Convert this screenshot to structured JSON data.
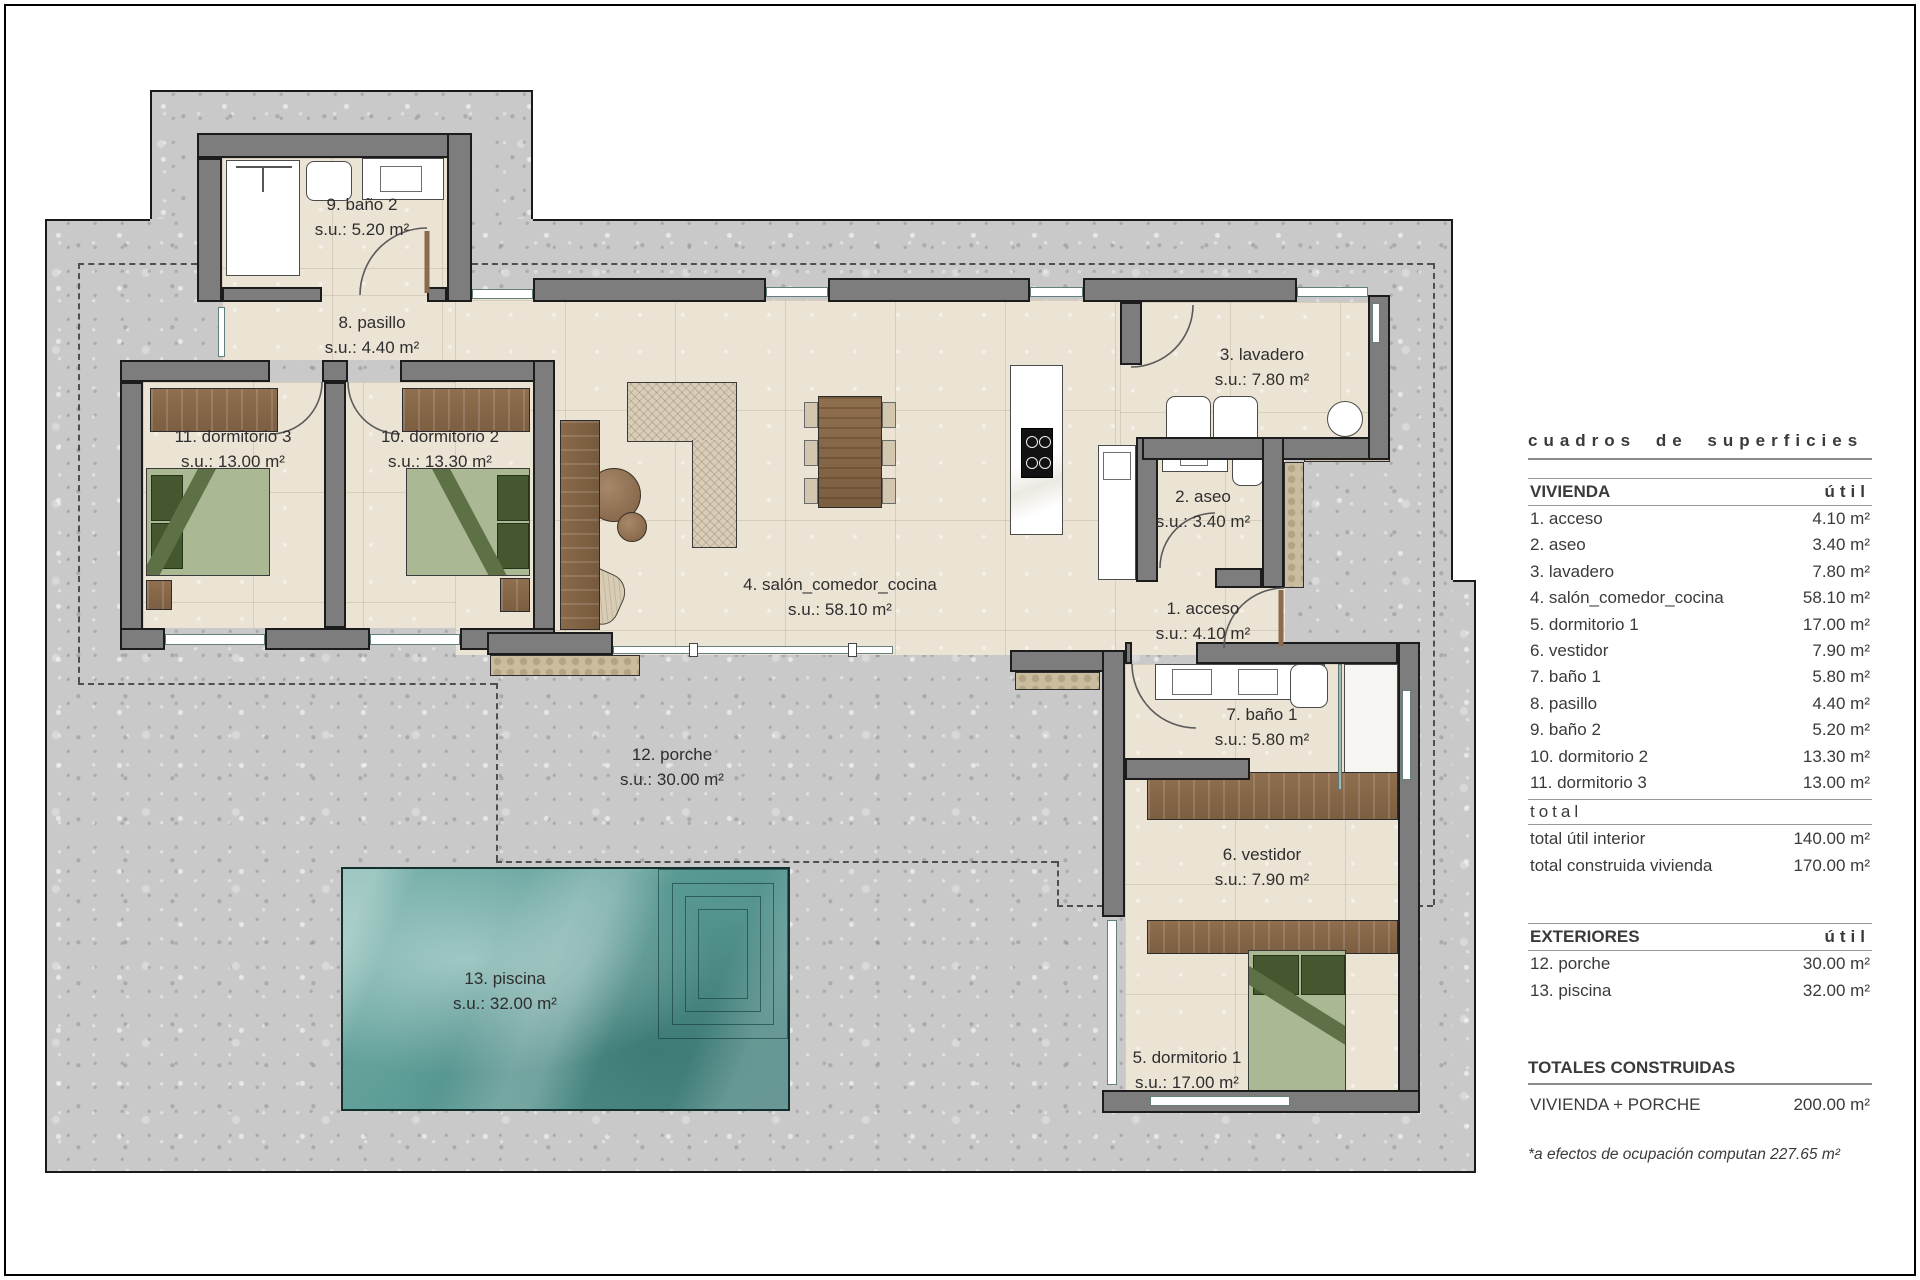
{
  "plan": {
    "rooms": [
      {
        "name": "1. acceso",
        "area": "s.u.: 4.10 m²"
      },
      {
        "name": "2. aseo",
        "area": "s.u.: 3.40 m²"
      },
      {
        "name": "3. lavadero",
        "area": "s.u.: 7.80 m²"
      },
      {
        "name": "4. salón_comedor_cocina",
        "area": "s.u.: 58.10 m²"
      },
      {
        "name": "5. dormitorio 1",
        "area": "s.u.: 17.00 m²"
      },
      {
        "name": "6. vestidor",
        "area": "s.u.: 7.90 m²"
      },
      {
        "name": "7. baño 1",
        "area": "s.u.: 5.80 m²"
      },
      {
        "name": "8. pasillo",
        "area": "s.u.: 4.40 m²"
      },
      {
        "name": "9. baño 2",
        "area": "s.u.: 5.20 m²"
      },
      {
        "name": "10. dormitorio 2",
        "area": "s.u.: 13.30 m²"
      },
      {
        "name": "11. dormitorio 3",
        "area": "s.u.: 13.00 m²"
      },
      {
        "name": "12. porche",
        "area": "s.u.: 30.00 m²"
      },
      {
        "name": "13. piscina",
        "area": "s.u.: 32.00 m²"
      }
    ]
  },
  "table": {
    "title": "cuadros de superficies",
    "vivienda_header": "VIVIENDA",
    "util_header": "útil",
    "vivienda_rows": [
      {
        "label": "1. acceso",
        "value": "4.10 m²"
      },
      {
        "label": "2. aseo",
        "value": "3.40 m²"
      },
      {
        "label": "3. lavadero",
        "value": "7.80 m²"
      },
      {
        "label": "4. salón_comedor_cocina",
        "value": "58.10 m²"
      },
      {
        "label": "5. dormitorio 1",
        "value": "17.00 m²"
      },
      {
        "label": "6. vestidor",
        "value": "7.90 m²"
      },
      {
        "label": "7. baño 1",
        "value": "5.80 m²"
      },
      {
        "label": "8. pasillo",
        "value": "4.40 m²"
      },
      {
        "label": "9. baño 2",
        "value": "5.20 m²"
      },
      {
        "label": "10. dormitorio 2",
        "value": "13.30 m²"
      },
      {
        "label": "11. dormitorio 3",
        "value": "13.00 m²"
      }
    ],
    "total_heading": "total",
    "vivienda_totals": [
      {
        "label": "total útil interior",
        "value": "140.00 m²"
      },
      {
        "label": "total construida vivienda",
        "value": "170.00 m²"
      }
    ],
    "exteriores_header": "EXTERIORES",
    "exteriores_util_header": "útil",
    "exteriores_rows": [
      {
        "label": "12. porche",
        "value": "30.00 m²"
      },
      {
        "label": "13. piscina",
        "value": "32.00 m²"
      }
    ],
    "totales_header": "TOTALES CONSTRUIDAS",
    "totales_rows": [
      {
        "label": "VIVIENDA + PORCHE",
        "value": "200.00 m²"
      }
    ],
    "note": "*a efectos de ocupación computan 227.65 m²"
  },
  "colors": {
    "plot": "#c9c9c9",
    "wall": "#7d7d7d",
    "floor": "#ebe3d4",
    "pool": "#579792",
    "wood": "#8a6b4d",
    "bed_green": "#aab893"
  }
}
